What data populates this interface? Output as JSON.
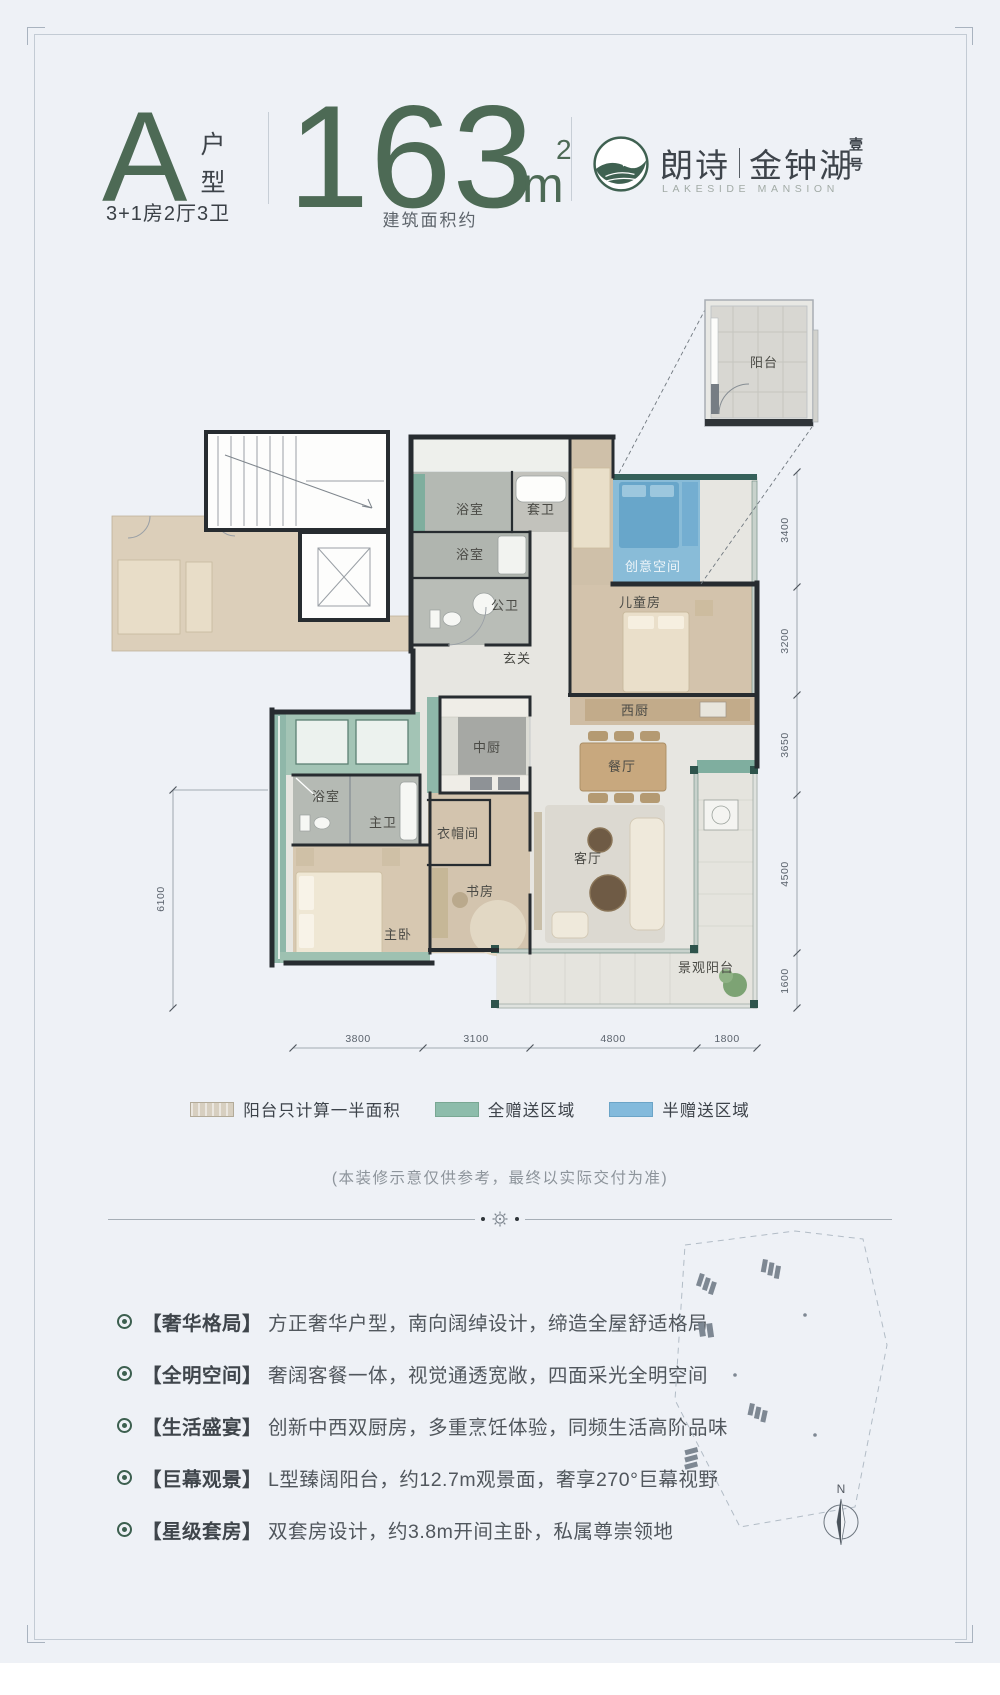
{
  "header": {
    "unit_letter": "A",
    "unit_label": "户型",
    "layout_spec": "3+1房2厅3卫",
    "area_number": "163",
    "area_unit": "m",
    "area_exponent": "2",
    "area_caption": "建筑面积约",
    "brand_cn_left": "朗诗",
    "brand_cn_right": "金钟湖",
    "brand_suffix": "壹号",
    "brand_en": "LAKESIDE MANSION"
  },
  "floorplan": {
    "inset_room": "阳台",
    "rooms": {
      "bath_top": "浴室",
      "suite_bath": "套卫",
      "bath_mid": "浴室",
      "public_bath": "公卫",
      "foyer": "玄关",
      "creative_space": "创意空间",
      "kids_room": "儿童房",
      "west_kitchen": "西厨",
      "chinese_kitchen": "中厨",
      "dining": "餐厅",
      "cloakroom": "衣帽间",
      "master_bath_shower": "浴室",
      "master_bath": "主卫",
      "study": "书房",
      "master_bedroom": "主卧",
      "living": "客厅",
      "view_balcony": "景观阳台"
    },
    "dims_right": [
      "3400",
      "3200",
      "3650",
      "4500",
      "1600"
    ],
    "dims_bottom": [
      "3800",
      "3100",
      "4800",
      "1800"
    ],
    "dim_left": "6100"
  },
  "legend": {
    "items": [
      {
        "label": "阳台只计算一半面积",
        "color": "#d7cfc0"
      },
      {
        "label": "全赠送区域",
        "color": "#8dbcab"
      },
      {
        "label": "半赠送区域",
        "color": "#83badc"
      }
    ]
  },
  "disclaimer": "(本装修示意仅供参考，最终以实际交付为准)",
  "features": [
    {
      "title": "【奢华格局】",
      "text": "方正奢华户型，南向阔绰设计，缔造全屋舒适格局"
    },
    {
      "title": "【全明空间】",
      "text": "奢阔客餐一体，视觉通透宽敞，四面采光全明空间"
    },
    {
      "title": "【生活盛宴】",
      "text": "创新中西双厨房，多重烹饪体验，同频生活高阶品味"
    },
    {
      "title": "【巨幕观景】",
      "text": "L型臻阔阳台，约12.7m观景面，奢享270°巨幕视野"
    },
    {
      "title": "【星级套房】",
      "text": "双套房设计，约3.8m开间主卧，私属尊崇领地"
    }
  ],
  "siteplan": {
    "compass_label": "N"
  },
  "colors": {
    "accent_green": "#4d6a55",
    "wall_dark": "#272c30"
  }
}
